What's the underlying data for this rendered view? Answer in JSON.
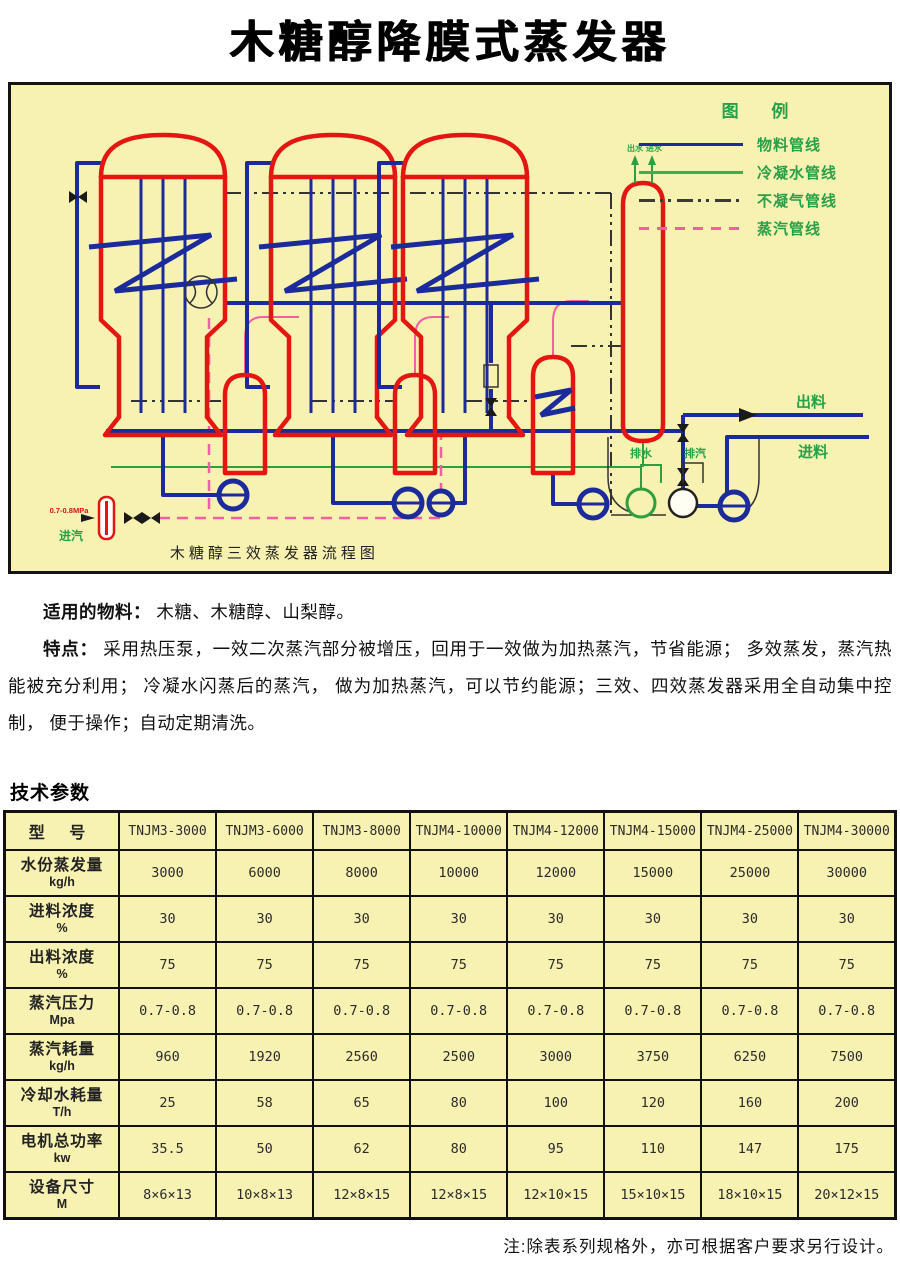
{
  "page": {
    "title": "木糖醇降膜式蒸发器"
  },
  "diagram": {
    "caption": "木糖醇三效蒸发器流程图",
    "legend": {
      "title": "图  例",
      "items": [
        {
          "label": "物料管线",
          "style": "solid",
          "color": "#1b2b9b"
        },
        {
          "label": "冷凝水管线",
          "style": "solid",
          "color": "#3fae4f"
        },
        {
          "label": "不凝气管线",
          "style": "dashdot",
          "color": "#3a3a3a"
        },
        {
          "label": "蒸汽管线",
          "style": "dashed",
          "color": "#f45fa4"
        }
      ]
    },
    "labels": {
      "outlet": "出料",
      "inlet": "进料",
      "drain": "排水",
      "vent": "排汽",
      "steam_in": "进汽",
      "pressure": "0.7-0.8MPa",
      "cond_out": "出水",
      "cond_in": "进水"
    }
  },
  "intro": {
    "materials_label": "适用的物料：",
    "materials_text": " 木糖、木糖醇、山梨醇。",
    "features_label": "特点：",
    "features_text": " 采用热压泵，一效二次蒸汽部分被增压，回用于一效做为加热蒸汽，节省能源； 多效蒸发，蒸汽热能被充分利用； 冷凝水闪蒸后的蒸汽， 做为加热蒸汽，可以节约能源；三效、四效蒸发器采用全自动集中控制， 便于操作；自动定期清洗。"
  },
  "specs": {
    "heading": "技术参数",
    "note": "注:除表系列规格外，亦可根据客户要求另行设计。",
    "table": {
      "model_label": "型  号",
      "models": [
        "TNJM3-3000",
        "TNJM3-6000",
        "TNJM3-8000",
        "TNJM4-10000",
        "TNJM4-12000",
        "TNJM4-15000",
        "TNJM4-25000",
        "TNJM4-30000"
      ],
      "rows": [
        {
          "name": "水份蒸发量",
          "unit": "kg/h",
          "values": [
            "3000",
            "6000",
            "8000",
            "10000",
            "12000",
            "15000",
            "25000",
            "30000"
          ]
        },
        {
          "name": "进料浓度",
          "unit": "%",
          "values": [
            "30",
            "30",
            "30",
            "30",
            "30",
            "30",
            "30",
            "30"
          ]
        },
        {
          "name": "出料浓度",
          "unit": "%",
          "values": [
            "75",
            "75",
            "75",
            "75",
            "75",
            "75",
            "75",
            "75"
          ]
        },
        {
          "name": "蒸汽压力",
          "unit": "Mpa",
          "values": [
            "0.7-0.8",
            "0.7-0.8",
            "0.7-0.8",
            "0.7-0.8",
            "0.7-0.8",
            "0.7-0.8",
            "0.7-0.8",
            "0.7-0.8"
          ]
        },
        {
          "name": "蒸汽耗量",
          "unit": "kg/h",
          "values": [
            "960",
            "1920",
            "2560",
            "2500",
            "3000",
            "3750",
            "6250",
            "7500"
          ]
        },
        {
          "name": "冷却水耗量",
          "unit": "T/h",
          "values": [
            "25",
            "58",
            "65",
            "80",
            "100",
            "120",
            "160",
            "200"
          ]
        },
        {
          "name": "电机总功率",
          "unit": "kw",
          "values": [
            "35.5",
            "50",
            "62",
            "80",
            "95",
            "110",
            "147",
            "175"
          ]
        },
        {
          "name": "设备尺寸",
          "unit": "M",
          "values": [
            "8×6×13",
            "10×8×13",
            "12×8×15",
            "12×8×15",
            "12×10×15",
            "15×10×15",
            "18×10×15",
            "20×12×15"
          ]
        }
      ]
    }
  }
}
